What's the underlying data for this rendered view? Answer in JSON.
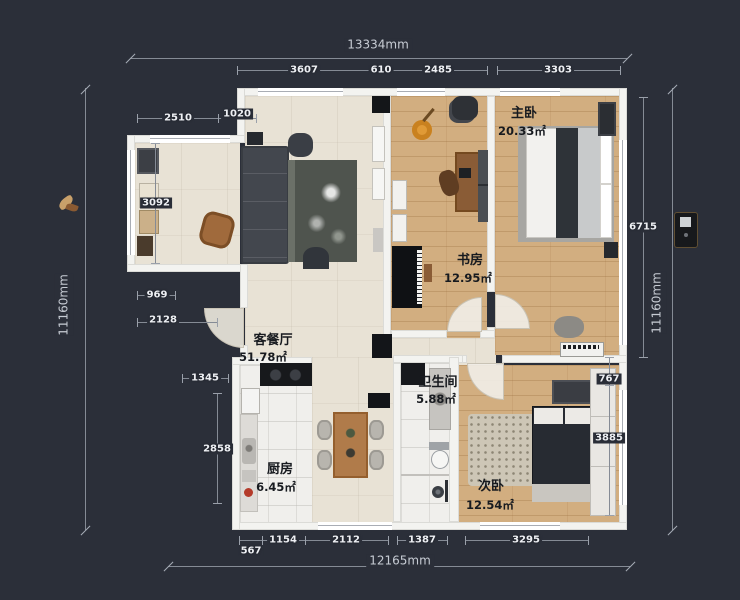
{
  "plan": {
    "rooms": [
      {
        "name": "客餐厅",
        "area": "51.78㎡"
      },
      {
        "name": "书房",
        "area": "12.95㎡"
      },
      {
        "name": "主卧",
        "area": "20.33㎡"
      },
      {
        "name": "卫生间",
        "area": "5.88㎡"
      },
      {
        "name": "厨房",
        "area": "6.45㎡"
      },
      {
        "name": "次卧",
        "area": "12.54㎡"
      }
    ],
    "overall": {
      "top": "13334mm",
      "bottom": "12165mm",
      "left": "11160mm",
      "right": "11160mm"
    },
    "chains": {
      "top": [
        "3607",
        "610",
        "2485",
        "3303"
      ],
      "left_width": [
        "2510",
        "1020"
      ],
      "left_side": [
        "3092",
        "969",
        "2128",
        "1345",
        "2858"
      ],
      "right_side": [
        "6715",
        "767",
        "3885"
      ],
      "bottom": [
        "567",
        "1154",
        "2112",
        "1387",
        "3295"
      ]
    },
    "colors": {
      "background": "#2b2f39",
      "wall": "#f3f3f0",
      "wood_floor": "#d2ae80",
      "beige_floor": "#e8e2d5",
      "marble_floor": "#f0efec",
      "dim_line": "#858b95",
      "dim_text": "#eef0f4",
      "room_label": "#171a1f"
    }
  }
}
